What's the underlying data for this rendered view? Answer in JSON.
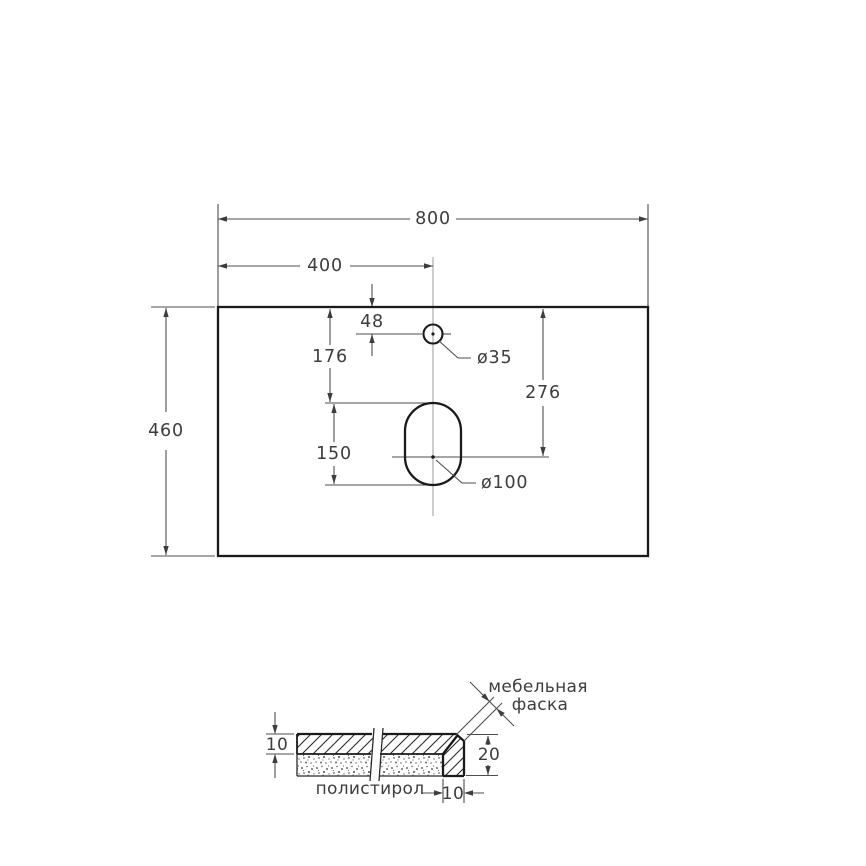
{
  "plan": {
    "width": "800",
    "center_offset": "400",
    "faucet_from_top": "48",
    "faucet_to_slot": "176",
    "slot_center_from_top": "276",
    "slot_length": "150",
    "depth": "460",
    "faucet_diameter": "ø35",
    "slot_diameter": "ø100"
  },
  "section": {
    "slab_thickness": "10",
    "edge_height": "20",
    "edge_width": "10",
    "chamfer_line1": "мебельная",
    "chamfer_line2": "фаска",
    "filler": "полистирол"
  },
  "colors": {
    "background": "#ffffff",
    "outline": "#1a1a1a",
    "dimension_lines": "#4d4d4d",
    "centerline": "#9b9b9b",
    "text": "#3d3d3d"
  }
}
